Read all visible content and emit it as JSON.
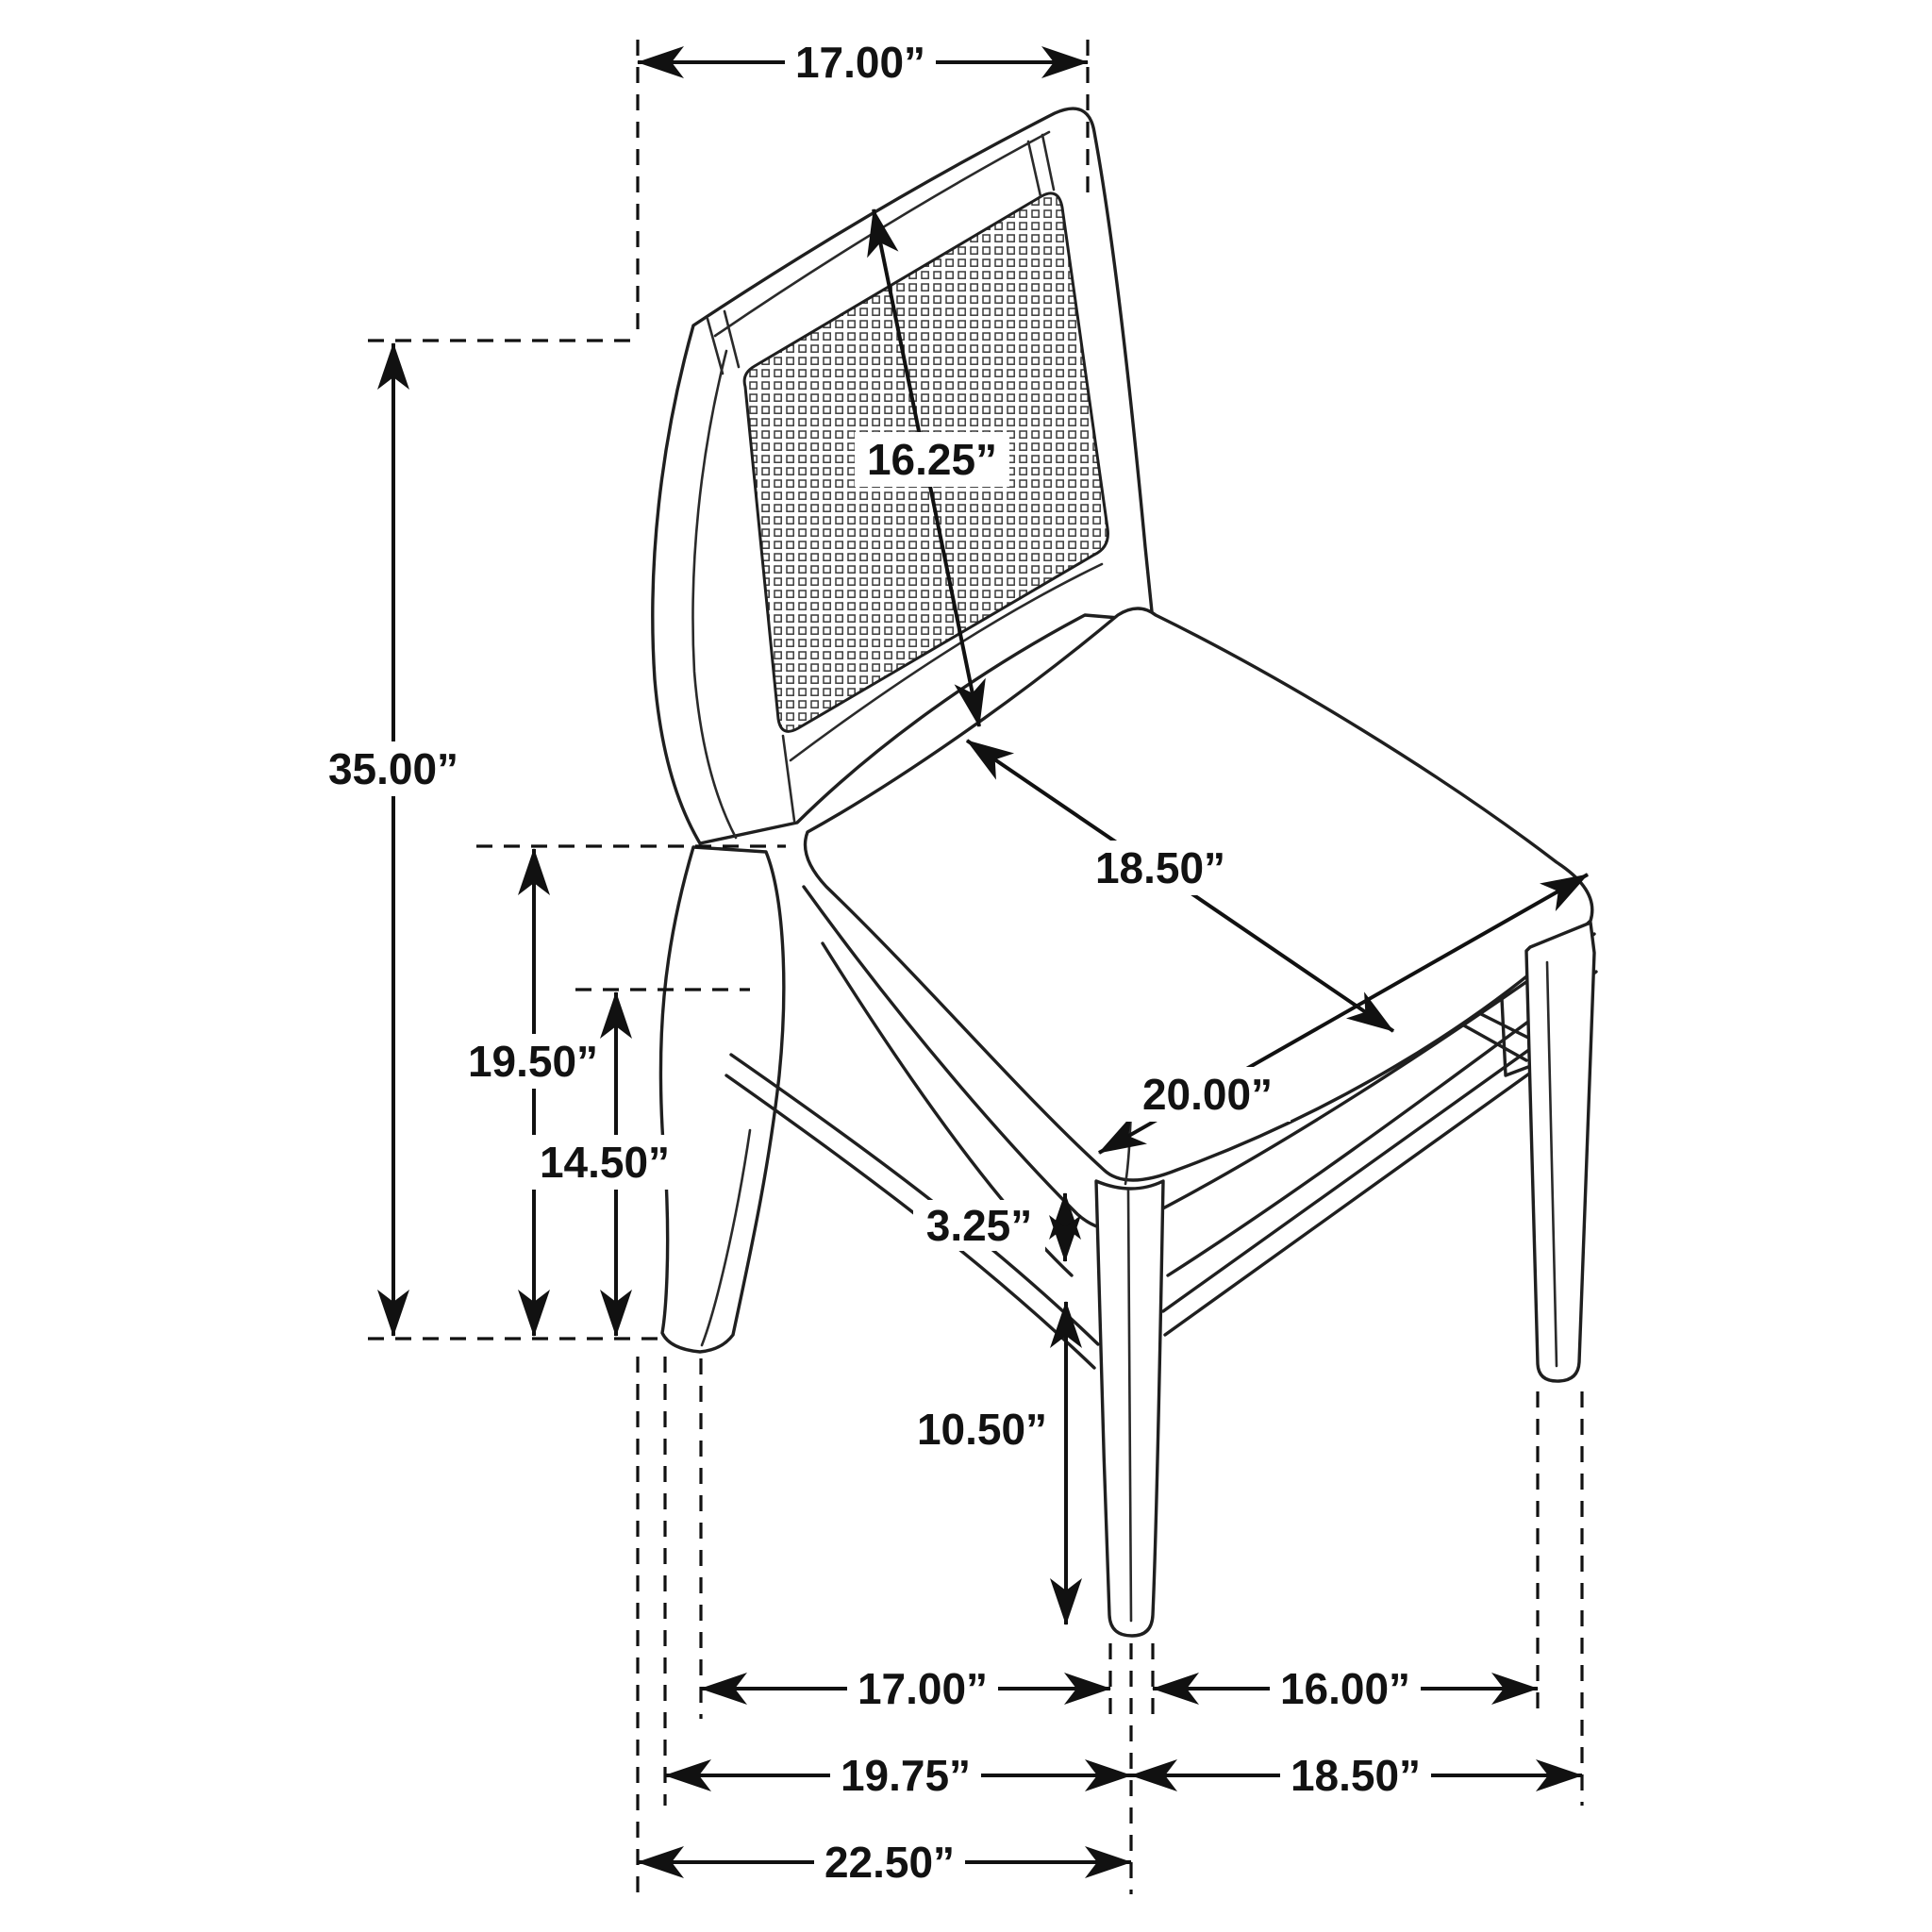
{
  "diagram": {
    "type": "furniture-dimension-drawing",
    "object": "dining side chair with cane back",
    "colors": {
      "line": "#1f1f1f",
      "background": "#ffffff",
      "label_text": "#121212"
    },
    "dims": {
      "back_width": "17.00”",
      "back_panel_height": "16.25”",
      "overall_height": "35.00”",
      "seat_height": "19.50”",
      "apron_height": "14.50”",
      "seat_depth": "18.50”",
      "seat_width": "20.00”",
      "stretcher_gap": "3.25”",
      "front_leg_height": "10.50”",
      "leg_span_side": "17.00”",
      "leg_span_front": "16.00”",
      "footprint_depth": "19.75”",
      "footprint_width": "18.50”",
      "overall_depth": "22.50”"
    }
  }
}
